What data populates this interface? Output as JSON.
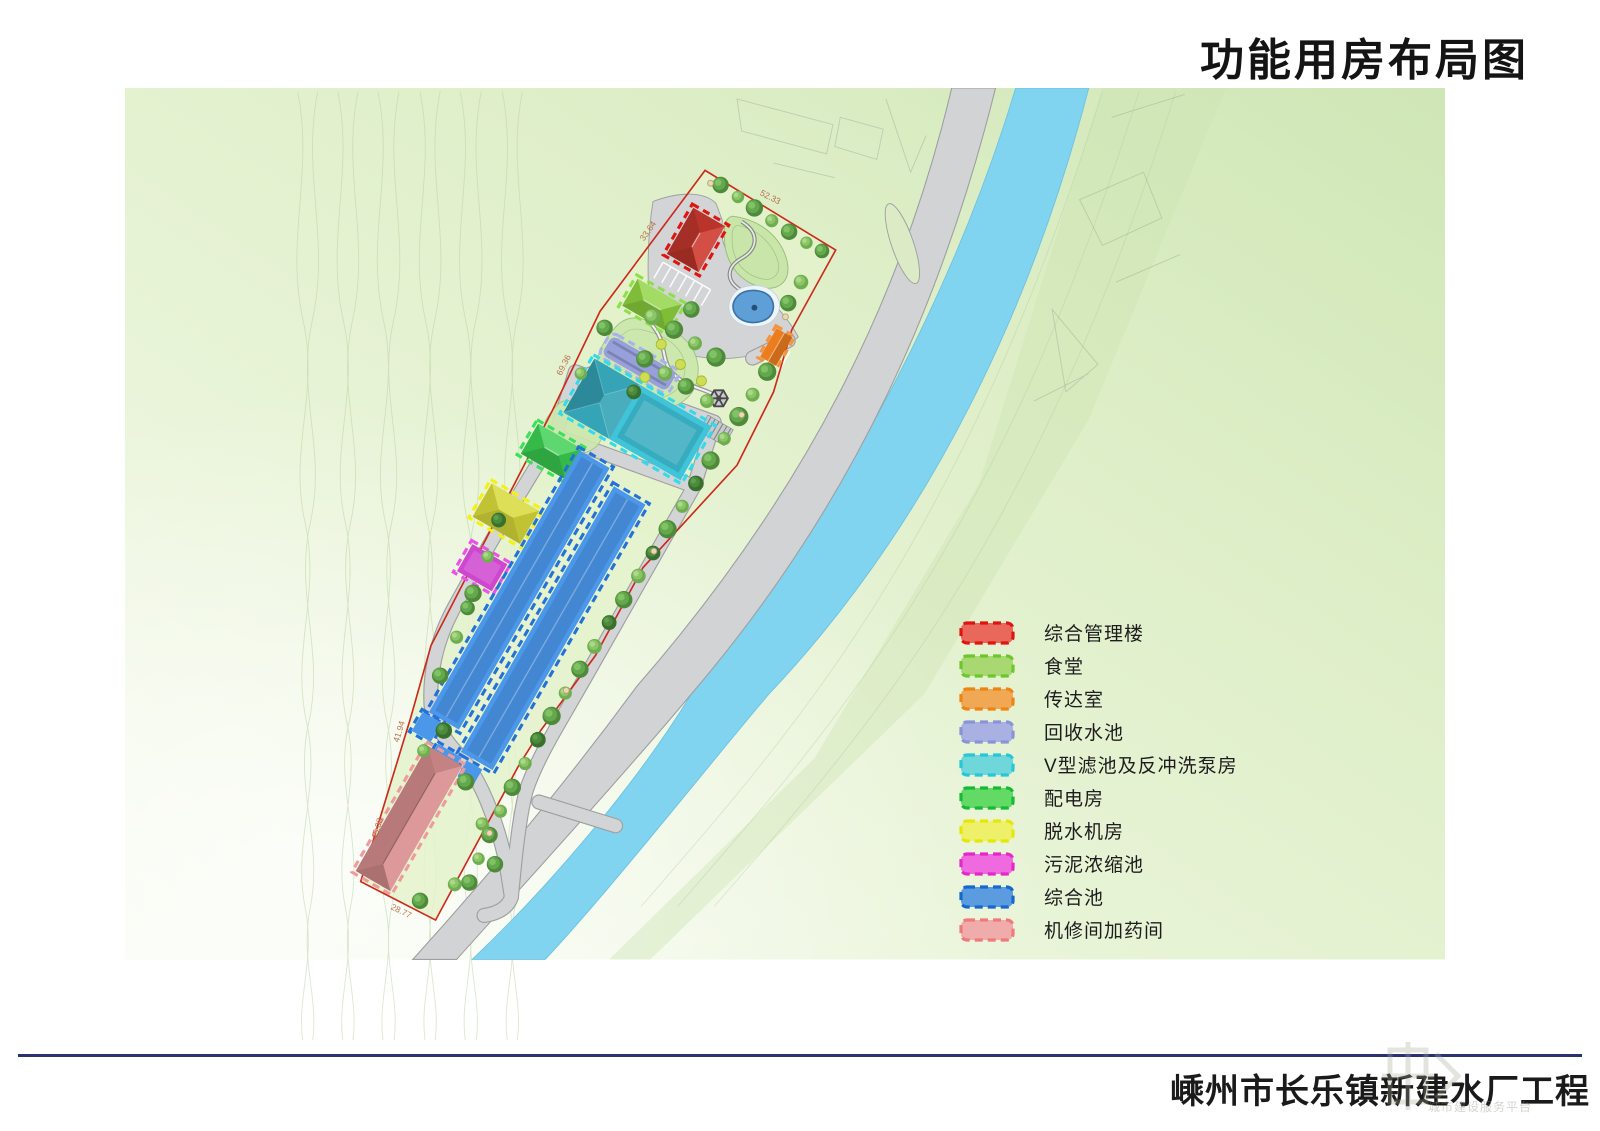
{
  "page": {
    "title": "功能用房布局图"
  },
  "footer": {
    "project_name": "嵊州市长乐镇新建水厂工程",
    "watermark_caption": "城市建设服务平台"
  },
  "legend": {
    "items": [
      {
        "label": "综合管理楼",
        "fill": "#e8695c",
        "border": "#e01510"
      },
      {
        "label": "食堂",
        "fill": "#a9d873",
        "border": "#6cc82a"
      },
      {
        "label": "传达室",
        "fill": "#f0a855",
        "border": "#ee8512"
      },
      {
        "label": "回收水池",
        "fill": "#a9b0e2",
        "border": "#8a93d8"
      },
      {
        "label": "V型滤池及反冲洗泵房",
        "fill": "#6fd6da",
        "border": "#26c8d8"
      },
      {
        "label": "配电房",
        "fill": "#63d966",
        "border": "#16bb35"
      },
      {
        "label": "脱水机房",
        "fill": "#eff06a",
        "border": "#e6e607"
      },
      {
        "label": "污泥浓缩池",
        "fill": "#ee6ade",
        "border": "#e628c9"
      },
      {
        "label": "综合池",
        "fill": "#5b9ce0",
        "border": "#1668cc"
      },
      {
        "label": "机修间加药间",
        "fill": "#f0abab",
        "border": "#ee7a7a"
      }
    ]
  },
  "map": {
    "river_color": "#80d4f0",
    "road_color": "#d2d3d5",
    "road_edge_color": "#9d9fa0",
    "boundary_color": "#cc2a1a",
    "buildings": [
      {
        "name": "综合管理楼",
        "fill": "#cf3a30",
        "border": "#e01510"
      },
      {
        "name": "食堂",
        "fill": "#8ed23f",
        "border": "#8ee04a"
      },
      {
        "name": "传达室",
        "fill": "#ec7d1e",
        "border": "#f29440"
      },
      {
        "name": "回收水池",
        "fill": "#97a0da",
        "border": "#aab2ec"
      },
      {
        "name": "V型滤池及反冲洗泵房",
        "fill": "#40c4da",
        "border": "#30dcec"
      },
      {
        "name": "配电房",
        "fill": "#3bcf52",
        "border": "#3ae25a"
      },
      {
        "name": "脱水机房",
        "fill": "#d8da3a",
        "border": "#f2f215"
      },
      {
        "name": "污泥浓缩池",
        "fill": "#cf46cf",
        "border": "#ea51ea"
      },
      {
        "name": "综合池",
        "fill": "#4b97ea",
        "border": "#2272d8"
      },
      {
        "name": "机修间加药间",
        "fill": "#db9191",
        "border": "#ef9b9b"
      }
    ],
    "dimension_labels": [
      {
        "text": "52.33"
      },
      {
        "text": "33.64"
      },
      {
        "text": "69.36"
      },
      {
        "text": "41.94"
      },
      {
        "text": "45.08"
      },
      {
        "text": "28.77"
      }
    ]
  }
}
